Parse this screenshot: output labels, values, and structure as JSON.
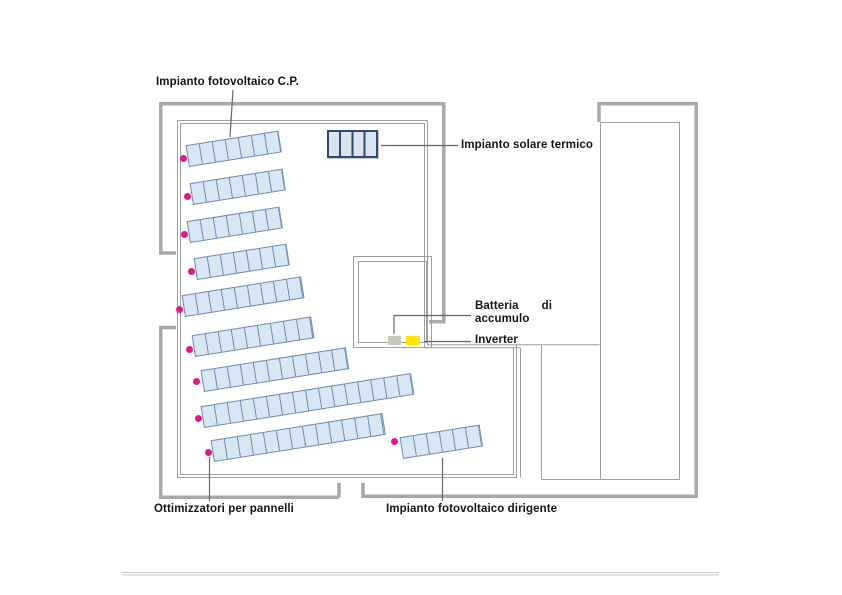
{
  "diagram": {
    "title_hidden": "",
    "labels": {
      "pv_cp": "Impianto fotovoltaico C.P.",
      "solar_thermal": "Impianto solare termico",
      "battery_word1": "Batteria",
      "battery_word2": "di",
      "battery_line2": "accumulo",
      "inverter": "Inverter",
      "optimizers": "Ottimizzatori per pannelli",
      "pv_dirigente": "Impianto fotovoltaico dirigente"
    },
    "colors": {
      "wall_thick": "#a9a8a2",
      "line_thin": "#9f9f9f",
      "leader": "#666666",
      "panel_fill": "#d9e6f3",
      "panel_border": "#6f8db3",
      "thermal_fill": "#dce3eb",
      "thermal_border": "#2d4a7a",
      "optimizer_dot": "#e7158c",
      "battery_fill": "#c9c9bb",
      "inverter_fill": "#ffe500",
      "separator": "#c9c9c9",
      "text": "#141414"
    },
    "panel_rows": [
      {
        "name": "cp-row-1",
        "x": 189,
        "y": 167,
        "cells": 7
      },
      {
        "name": "cp-row-2",
        "x": 193,
        "y": 205,
        "cells": 7
      },
      {
        "name": "cp-row-3",
        "x": 190,
        "y": 243,
        "cells": 7
      },
      {
        "name": "cp-row-4",
        "x": 197,
        "y": 280,
        "cells": 7
      },
      {
        "name": "cp-row-5",
        "x": 185,
        "y": 317,
        "cells": 9
      },
      {
        "name": "cp-row-6",
        "x": 195,
        "y": 357,
        "cells": 9
      },
      {
        "name": "cp-row-7",
        "x": 204,
        "y": 392,
        "cells": 11
      },
      {
        "name": "cp-row-8",
        "x": 204,
        "y": 428,
        "cells": 16
      },
      {
        "name": "cp-row-9",
        "x": 214,
        "y": 462,
        "cells": 13
      },
      {
        "name": "dirigente-row",
        "x": 403,
        "y": 459,
        "cells": 6
      }
    ],
    "cell_width": 13.2,
    "row_height": 22,
    "row_tilt_deg": -9,
    "optimizer_dots": [
      {
        "x": 183,
        "y": 158
      },
      {
        "x": 187,
        "y": 196
      },
      {
        "x": 184,
        "y": 234
      },
      {
        "x": 191,
        "y": 271
      },
      {
        "x": 179,
        "y": 309
      },
      {
        "x": 189,
        "y": 349
      },
      {
        "x": 196,
        "y": 381
      },
      {
        "x": 198,
        "y": 418
      },
      {
        "x": 208,
        "y": 452
      },
      {
        "x": 394,
        "y": 441
      }
    ],
    "thermal_panel": {
      "x": 327,
      "y": 130,
      "w": 51,
      "h": 28
    },
    "battery_box": {
      "x": 388,
      "y": 336,
      "w": 13,
      "h": 9
    },
    "inverter_box": {
      "x": 406,
      "y": 336,
      "w": 14,
      "h": 9
    }
  }
}
